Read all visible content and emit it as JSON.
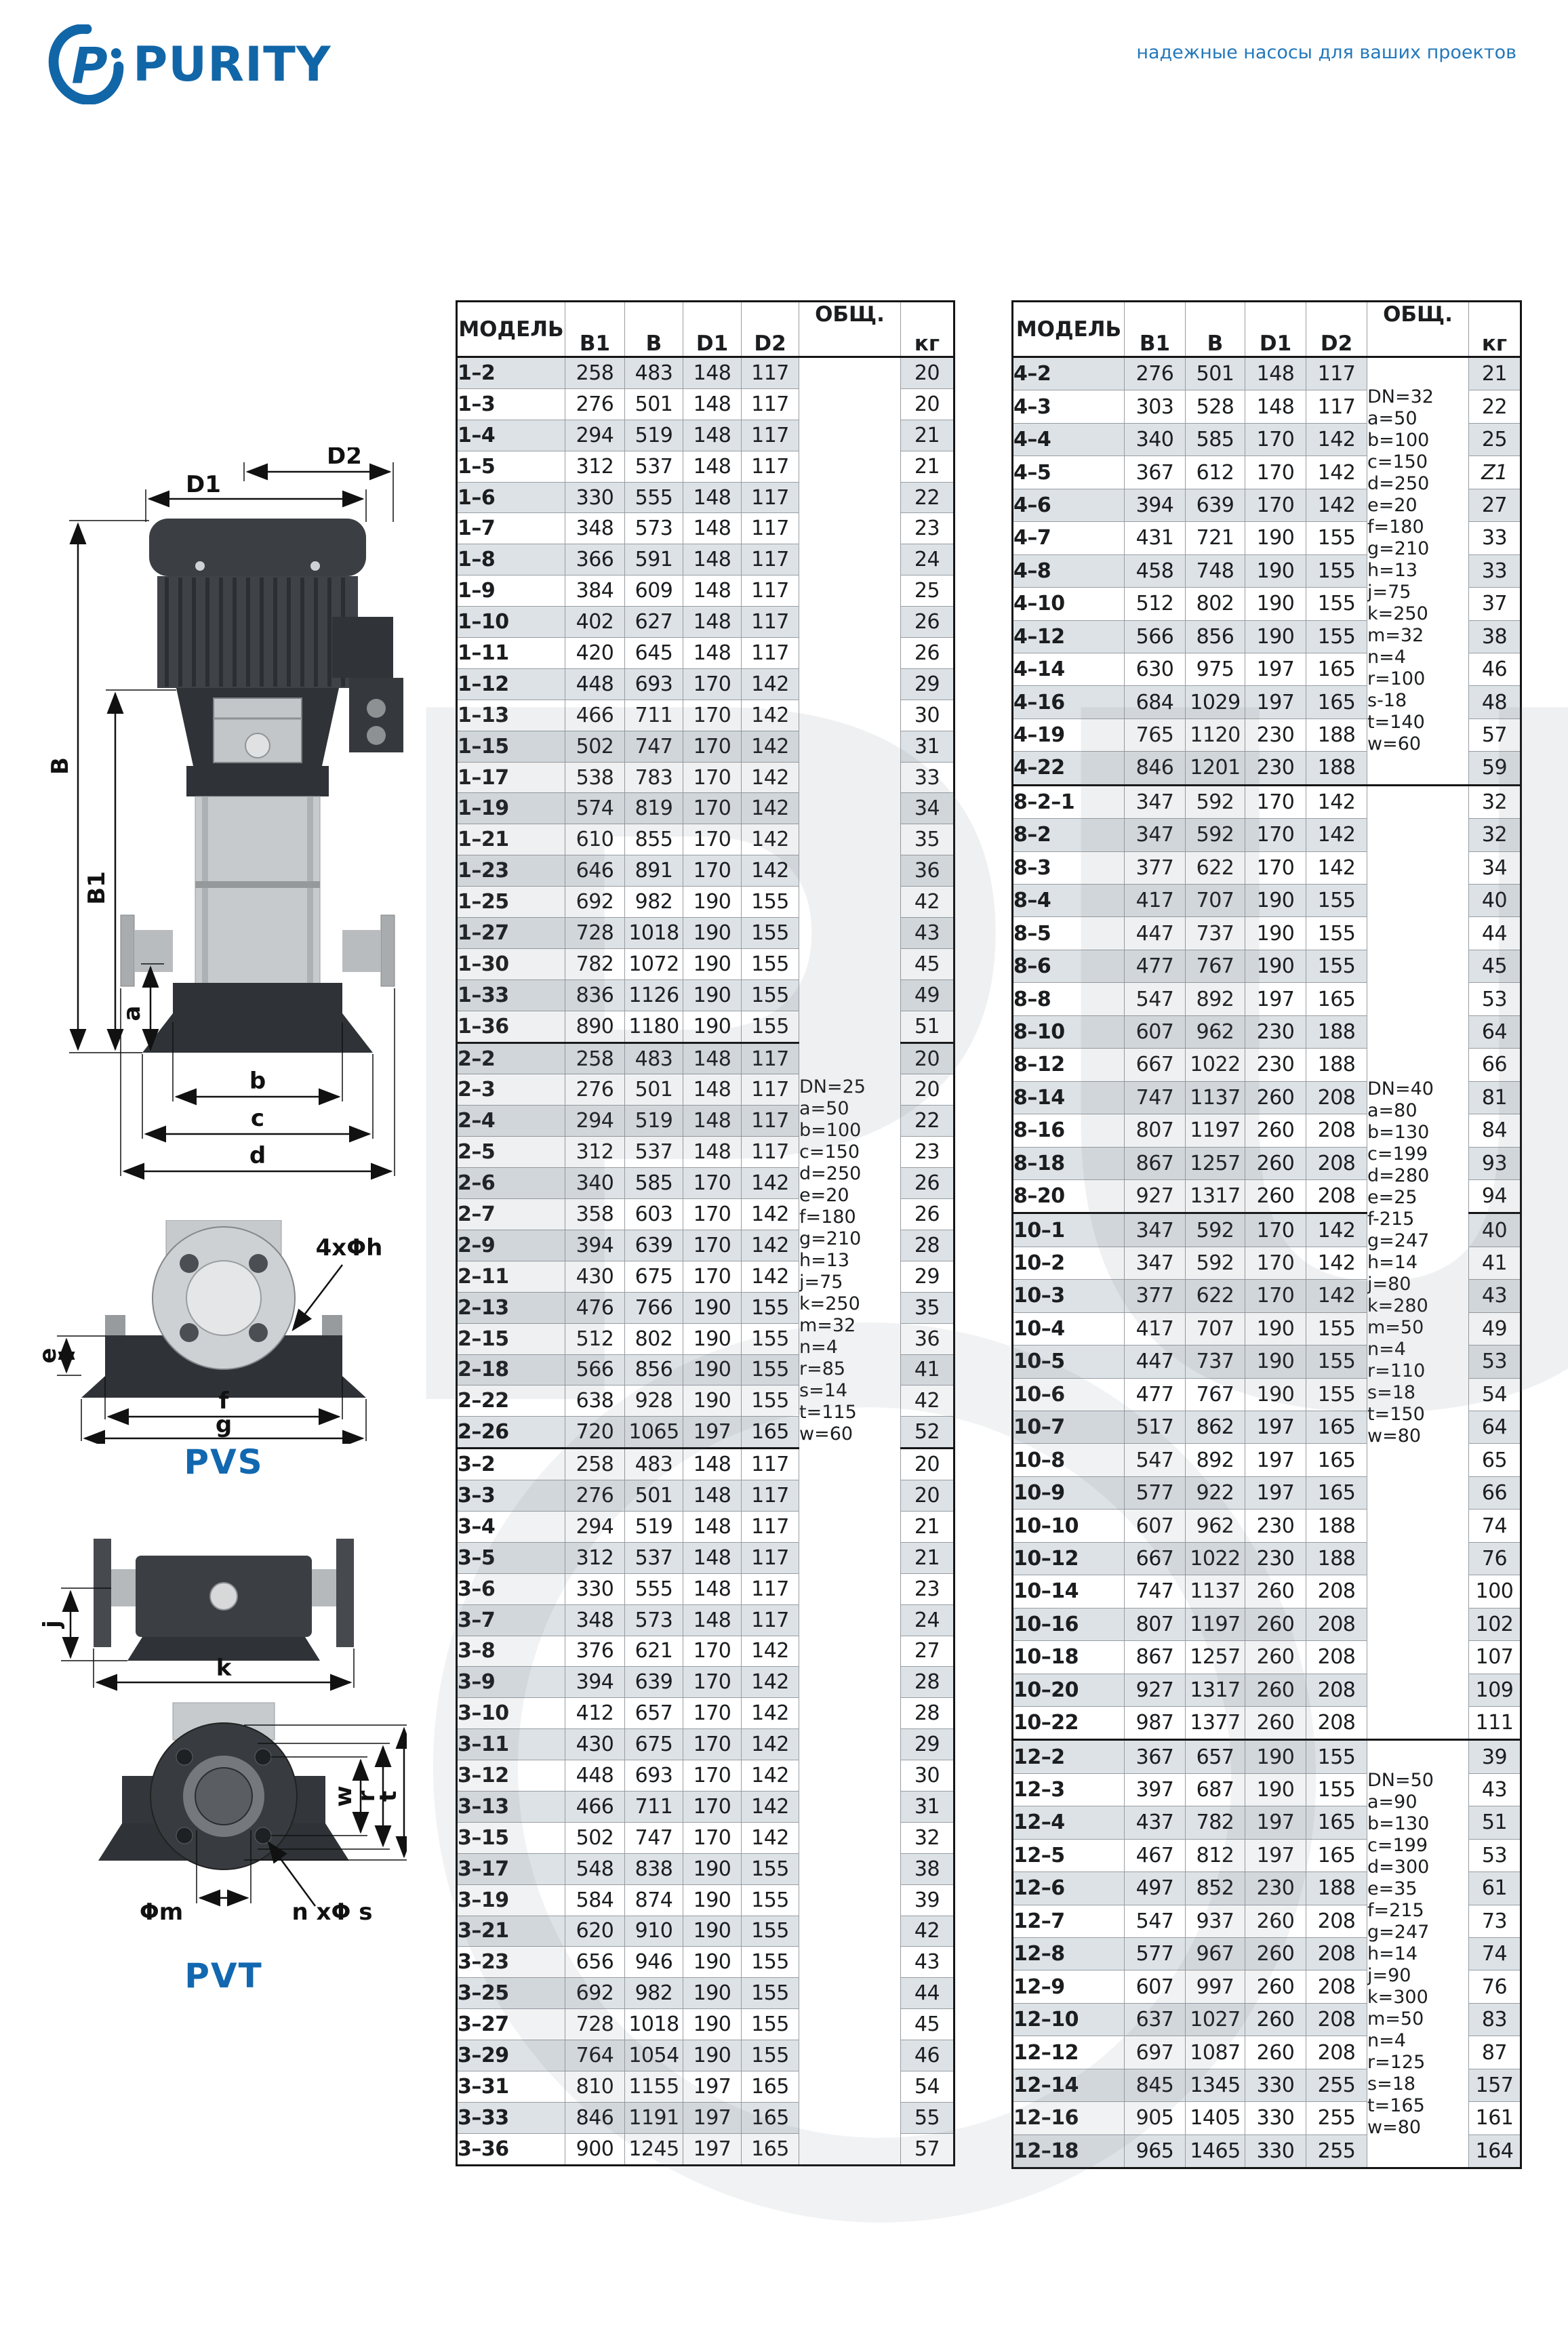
{
  "brand": {
    "name": "PURITY",
    "tagline": "надежные насосы для ваших проектов",
    "accent_blue": "#1268b0"
  },
  "watermark": {
    "text": "PURITY"
  },
  "diagrams": {
    "pvs": {
      "caption": "PVS",
      "d2": "D2",
      "d1": "D1",
      "B": "B",
      "B1": "B1",
      "a": "a",
      "b": "b",
      "c": "c",
      "d": "d",
      "e": "e",
      "f": "f",
      "g": "g",
      "holes": "4xΦh"
    },
    "pvt": {
      "caption": "PVT",
      "j": "j",
      "k": "k",
      "w": "w",
      "r": "r",
      "t": "t",
      "hub": "Φm",
      "holes": "n xΦ s"
    }
  },
  "tables": {
    "left": {
      "headers": {
        "model": "МОДЕЛЬ",
        "b1": "B1",
        "b": "B",
        "d1": "D1",
        "d2": "D2",
        "total": "ОБЩ.",
        "kg": "кг"
      },
      "groups": [
        {
          "notes": [
            "DN=25",
            "a=50",
            "b=100",
            "c=150",
            "d=250",
            "e=20",
            "f=180",
            "g=210",
            "h=13",
            "j=75",
            "k=250",
            "m=32",
            "n=4",
            "r=85",
            "s=14",
            "t=115",
            "w=60"
          ],
          "thick_at": [
            22,
            35
          ],
          "rows": [
            [
              "1–2",
              258,
              483,
              148,
              117,
              20
            ],
            [
              "1–3",
              276,
              501,
              148,
              117,
              20
            ],
            [
              "1–4",
              294,
              519,
              148,
              117,
              21
            ],
            [
              "1–5",
              312,
              537,
              148,
              117,
              21
            ],
            [
              "1–6",
              330,
              555,
              148,
              117,
              22
            ],
            [
              "1–7",
              348,
              573,
              148,
              117,
              23
            ],
            [
              "1–8",
              366,
              591,
              148,
              117,
              24
            ],
            [
              "1–9",
              384,
              609,
              148,
              117,
              25
            ],
            [
              "1–10",
              402,
              627,
              148,
              117,
              26
            ],
            [
              "1–11",
              420,
              645,
              148,
              117,
              26
            ],
            [
              "1–12",
              448,
              693,
              170,
              142,
              29
            ],
            [
              "1–13",
              466,
              711,
              170,
              142,
              30
            ],
            [
              "1–15",
              502,
              747,
              170,
              142,
              31
            ],
            [
              "1–17",
              538,
              783,
              170,
              142,
              33
            ],
            [
              "1–19",
              574,
              819,
              170,
              142,
              34
            ],
            [
              "1–21",
              610,
              855,
              170,
              142,
              35
            ],
            [
              "1–23",
              646,
              891,
              170,
              142,
              36
            ],
            [
              "1–25",
              692,
              982,
              190,
              155,
              42
            ],
            [
              "1–27",
              728,
              1018,
              190,
              155,
              43
            ],
            [
              "1–30",
              782,
              1072,
              190,
              155,
              45
            ],
            [
              "1–33",
              836,
              1126,
              190,
              155,
              49
            ],
            [
              "1–36",
              890,
              1180,
              190,
              155,
              51
            ],
            [
              "2–2",
              258,
              483,
              148,
              117,
              20
            ],
            [
              "2–3",
              276,
              501,
              148,
              117,
              20
            ],
            [
              "2–4",
              294,
              519,
              148,
              117,
              22
            ],
            [
              "2–5",
              312,
              537,
              148,
              117,
              23
            ],
            [
              "2–6",
              340,
              585,
              170,
              142,
              26
            ],
            [
              "2–7",
              358,
              603,
              170,
              142,
              26
            ],
            [
              "2–9",
              394,
              639,
              170,
              142,
              28
            ],
            [
              "2–11",
              430,
              675,
              170,
              142,
              29
            ],
            [
              "2–13",
              476,
              766,
              190,
              155,
              35
            ],
            [
              "2–15",
              512,
              802,
              190,
              155,
              36
            ],
            [
              "2–18",
              566,
              856,
              190,
              155,
              41
            ],
            [
              "2–22",
              638,
              928,
              190,
              155,
              42
            ],
            [
              "2–26",
              720,
              1065,
              197,
              165,
              52
            ],
            [
              "3–2",
              258,
              483,
              148,
              117,
              20
            ],
            [
              "3–3",
              276,
              501,
              148,
              117,
              20
            ],
            [
              "3–4",
              294,
              519,
              148,
              117,
              21
            ],
            [
              "3–5",
              312,
              537,
              148,
              117,
              21
            ],
            [
              "3–6",
              330,
              555,
              148,
              117,
              23
            ],
            [
              "3–7",
              348,
              573,
              148,
              117,
              24
            ],
            [
              "3–8",
              376,
              621,
              170,
              142,
              27
            ],
            [
              "3–9",
              394,
              639,
              170,
              142,
              28
            ],
            [
              "3–10",
              412,
              657,
              170,
              142,
              28
            ],
            [
              "3–11",
              430,
              675,
              170,
              142,
              29
            ],
            [
              "3–12",
              448,
              693,
              170,
              142,
              30
            ],
            [
              "3–13",
              466,
              711,
              170,
              142,
              31
            ],
            [
              "3–15",
              502,
              747,
              170,
              142,
              32
            ],
            [
              "3–17",
              548,
              838,
              190,
              155,
              38
            ],
            [
              "3–19",
              584,
              874,
              190,
              155,
              39
            ],
            [
              "3–21",
              620,
              910,
              190,
              155,
              42
            ],
            [
              "3–23",
              656,
              946,
              190,
              155,
              43
            ],
            [
              "3–25",
              692,
              982,
              190,
              155,
              44
            ],
            [
              "3–27",
              728,
              1018,
              190,
              155,
              45
            ],
            [
              "3–29",
              764,
              1054,
              190,
              155,
              46
            ],
            [
              "3–31",
              810,
              1155,
              197,
              165,
              54
            ],
            [
              "3–33",
              846,
              1191,
              197,
              165,
              55
            ],
            [
              "3–36",
              900,
              1245,
              197,
              165,
              57
            ]
          ]
        }
      ]
    },
    "right": {
      "headers": {
        "model": "МОДЕЛЬ",
        "b1": "B1",
        "b": "B",
        "d1": "D1",
        "d2": "D2",
        "total": "ОБЩ.",
        "kg": "кг"
      },
      "groups": [
        {
          "notes": [
            "DN=32",
            "a=50",
            "b=100",
            "c=150",
            "d=250",
            "e=20",
            "f=180",
            "g=210",
            "h=13",
            "j=75",
            "k=250",
            "m=32",
            "n=4",
            "r=100",
            "s-18",
            "t=140",
            "w=60"
          ],
          "rows": [
            [
              "4–2",
              276,
              501,
              148,
              117,
              21
            ],
            [
              "4–3",
              303,
              528,
              148,
              117,
              22
            ],
            [
              "4–4",
              340,
              585,
              170,
              142,
              25
            ],
            [
              "4–5",
              367,
              612,
              170,
              142,
              "Z1"
            ],
            [
              "4–6",
              394,
              639,
              170,
              142,
              27
            ],
            [
              "4–7",
              431,
              721,
              190,
              155,
              33
            ],
            [
              "4–8",
              458,
              748,
              190,
              155,
              33
            ],
            [
              "4–10",
              512,
              802,
              190,
              155,
              37
            ],
            [
              "4–12",
              566,
              856,
              190,
              155,
              38
            ],
            [
              "4–14",
              630,
              975,
              197,
              165,
              46
            ],
            [
              "4–16",
              684,
              1029,
              197,
              165,
              48
            ],
            [
              "4–19",
              765,
              1120,
              230,
              188,
              57
            ],
            [
              "4–22",
              846,
              1201,
              230,
              188,
              59
            ]
          ]
        },
        {
          "notes": [
            "DN=40",
            "a=80",
            "b=130",
            "c=199",
            "d=280",
            "e=25",
            "f-215",
            "g=247",
            "h=14",
            "j=80",
            "k=280",
            "m=50",
            "n=4",
            "r=110",
            "s=18",
            "t=150",
            "w=80"
          ],
          "thick_at": [
            13
          ],
          "rows": [
            [
              "8–2–1",
              347,
              592,
              170,
              142,
              32
            ],
            [
              "8–2",
              347,
              592,
              170,
              142,
              32
            ],
            [
              "8–3",
              377,
              622,
              170,
              142,
              34
            ],
            [
              "8–4",
              417,
              707,
              190,
              155,
              40
            ],
            [
              "8–5",
              447,
              737,
              190,
              155,
              44
            ],
            [
              "8–6",
              477,
              767,
              190,
              155,
              45
            ],
            [
              "8–8",
              547,
              892,
              197,
              165,
              53
            ],
            [
              "8–10",
              607,
              962,
              230,
              188,
              64
            ],
            [
              "8–12",
              667,
              1022,
              230,
              188,
              66
            ],
            [
              "8–14",
              747,
              1137,
              260,
              208,
              81
            ],
            [
              "8–16",
              807,
              1197,
              260,
              208,
              84
            ],
            [
              "8–18",
              867,
              1257,
              260,
              208,
              93
            ],
            [
              "8–20",
              927,
              1317,
              260,
              208,
              94
            ],
            [
              "10–1",
              347,
              592,
              170,
              142,
              40
            ],
            [
              "10–2",
              347,
              592,
              170,
              142,
              41
            ],
            [
              "10–3",
              377,
              622,
              170,
              142,
              43
            ],
            [
              "10–4",
              417,
              707,
              190,
              155,
              49
            ],
            [
              "10–5",
              447,
              737,
              190,
              155,
              53
            ],
            [
              "10–6",
              477,
              767,
              190,
              155,
              54
            ],
            [
              "10–7",
              517,
              862,
              197,
              165,
              64
            ],
            [
              "10–8",
              547,
              892,
              197,
              165,
              65
            ],
            [
              "10–9",
              577,
              922,
              197,
              165,
              66
            ],
            [
              "10–10",
              607,
              962,
              230,
              188,
              74
            ],
            [
              "10–12",
              667,
              1022,
              230,
              188,
              76
            ],
            [
              "10–14",
              747,
              1137,
              260,
              208,
              100
            ],
            [
              "10–16",
              807,
              1197,
              260,
              208,
              102
            ],
            [
              "10–18",
              867,
              1257,
              260,
              208,
              107
            ],
            [
              "10–20",
              927,
              1317,
              260,
              208,
              109
            ],
            [
              "10–22",
              987,
              1377,
              260,
              208,
              111
            ]
          ]
        },
        {
          "notes": [
            "DN=50",
            "a=90",
            "b=130",
            "c=199",
            "d=300",
            "e=35",
            "f=215",
            "g=247",
            "h=14",
            "j=90",
            "k=300",
            "m=50",
            "n=4",
            "r=125",
            "s=18",
            "t=165",
            "w=80"
          ],
          "rows": [
            [
              "12–2",
              367,
              657,
              190,
              155,
              39
            ],
            [
              "12–3",
              397,
              687,
              190,
              155,
              43
            ],
            [
              "12–4",
              437,
              782,
              197,
              165,
              51
            ],
            [
              "12–5",
              467,
              812,
              197,
              165,
              53
            ],
            [
              "12–6",
              497,
              852,
              230,
              188,
              61
            ],
            [
              "12–7",
              547,
              937,
              260,
              208,
              73
            ],
            [
              "12–8",
              577,
              967,
              260,
              208,
              74
            ],
            [
              "12–9",
              607,
              997,
              260,
              208,
              76
            ],
            [
              "12–10",
              637,
              1027,
              260,
              208,
              83
            ],
            [
              "12–12",
              697,
              1087,
              260,
              208,
              87
            ],
            [
              "12–14",
              845,
              1345,
              330,
              255,
              157
            ],
            [
              "12–16",
              905,
              1405,
              330,
              255,
              161
            ],
            [
              "12–18",
              965,
              1465,
              330,
              255,
              164
            ]
          ]
        }
      ]
    }
  }
}
